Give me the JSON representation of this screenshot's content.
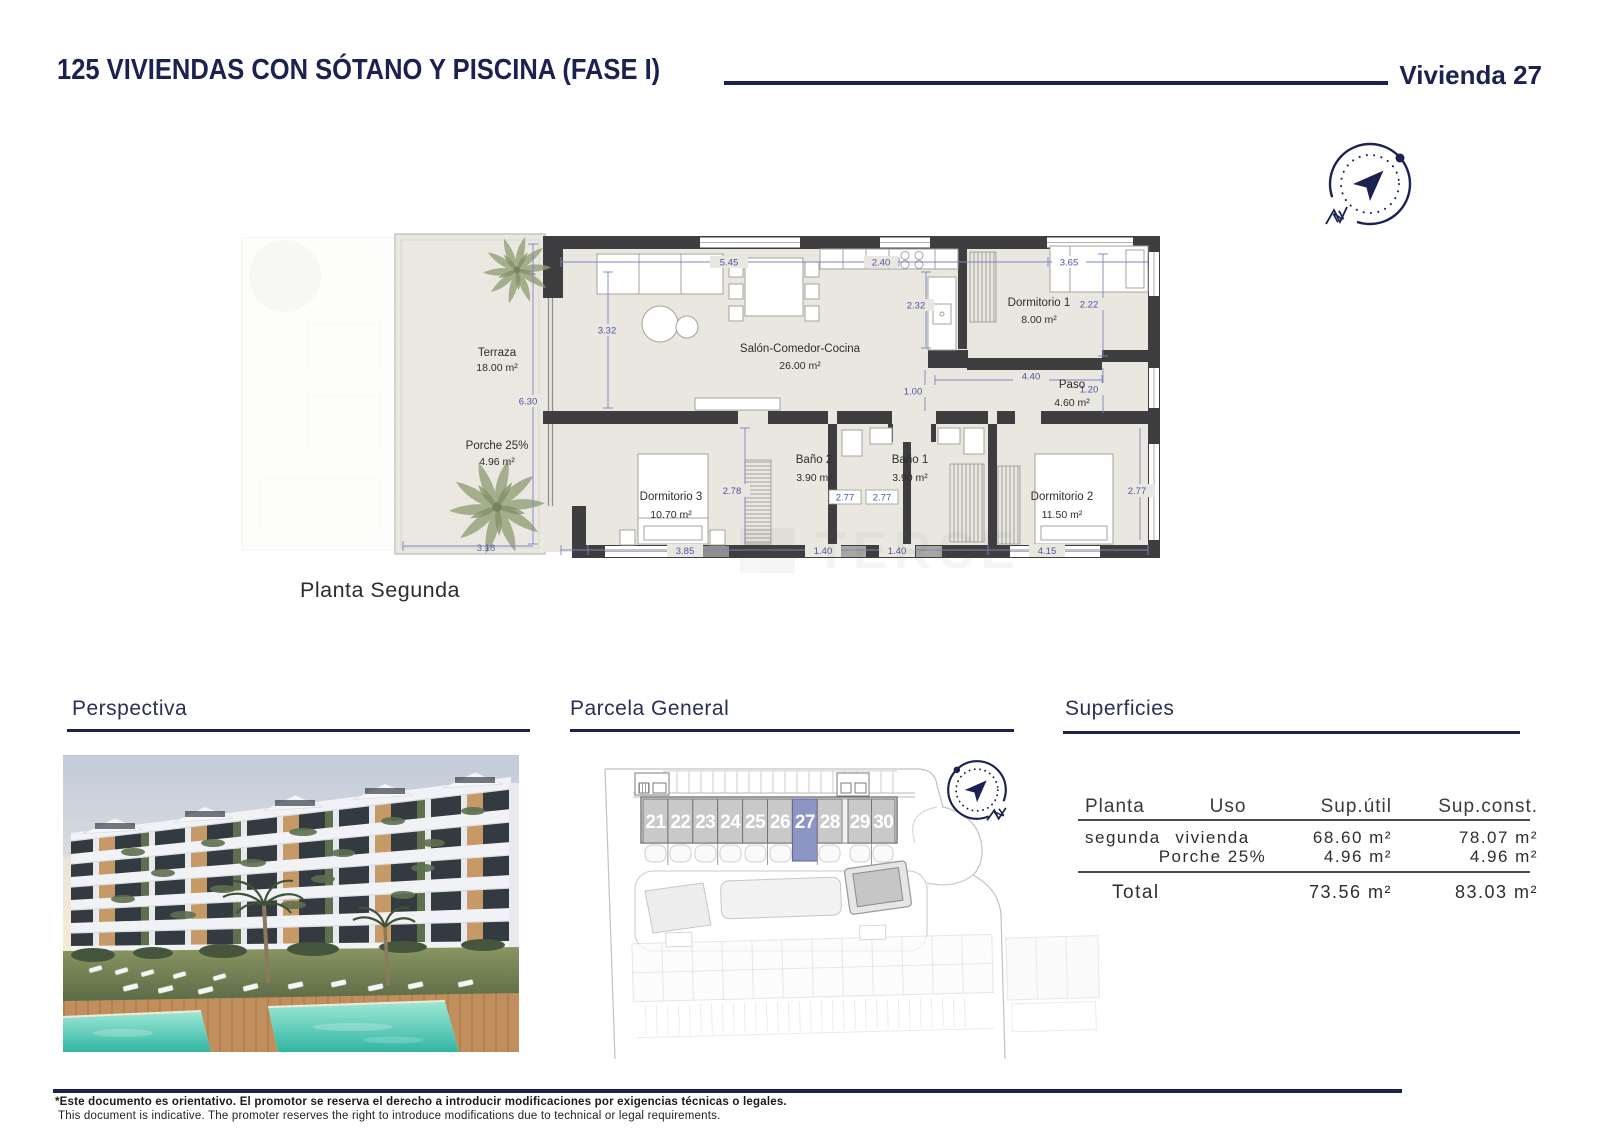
{
  "header": {
    "title": "125 VIVIENDAS CON SÓTANO Y PISCINA (FASE I)",
    "unit_label": "Vivienda 27"
  },
  "compass": {
    "north": "N"
  },
  "floorplan": {
    "caption": "Planta Segunda",
    "watermark": "TERCE",
    "rooms": {
      "terraza": {
        "name": "Terraza",
        "area": "18.00 m²"
      },
      "porche": {
        "name": "Porche 25%",
        "area": "4.96 m²"
      },
      "salon": {
        "name": "Salón-Comedor-Cocina",
        "area": "26.00 m²"
      },
      "dormitorio1": {
        "name": "Dormitorio 1",
        "area": "8.00 m²"
      },
      "paso": {
        "name": "Paso",
        "area": "4.60 m²"
      },
      "dormitorio3": {
        "name": "Dormitorio 3",
        "area": "10.70 m²"
      },
      "bano2": {
        "name": "Baño 2",
        "area": "3.90 m²"
      },
      "bano1": {
        "name": "Baño 1",
        "area": "3.90 m²"
      },
      "dormitorio2": {
        "name": "Dormitorio 2",
        "area": "11.50 m²"
      }
    },
    "dims": {
      "top_a": "5.45",
      "top_b": "2.40",
      "top_c": "3.65",
      "v_living": "3.32",
      "v_kitchen": "2.32",
      "v_dorm1": "2.22",
      "v_terraza": "6.30",
      "h_paso": "4.40",
      "v_corridor": "1.00",
      "w_paso_door": "1.20",
      "v_dorm3": "2.78",
      "w_bano2": "2.77",
      "w_bano1": "2.77",
      "v_dorm2": "2.77",
      "bot_terraza": "3.18",
      "bot_dorm3": "3.85",
      "bot_bano2": "1.40",
      "bot_bano1": "1.40",
      "bot_dorm2": "4.15"
    }
  },
  "sections": {
    "perspectiva": {
      "title": "Perspectiva"
    },
    "parcela": {
      "title": "Parcela General",
      "units": [
        "21",
        "22",
        "23",
        "24",
        "25",
        "26",
        "27",
        "28",
        "29",
        "30"
      ],
      "highlighted_unit": "27"
    },
    "superficies": {
      "title": "Superficies",
      "col_planta": "Planta",
      "col_uso": "Uso",
      "col_util": "Sup.útil",
      "col_const": "Sup.const.",
      "row1": {
        "planta": "segunda",
        "uso": "vivienda",
        "util": "68.60 m²",
        "const": "78.07 m²"
      },
      "row2": {
        "uso": "Porche 25%",
        "util": "4.96 m²",
        "const": "4.96 m²"
      },
      "total": {
        "label": "Total",
        "util": "73.56 m²",
        "const": "83.03 m²"
      }
    }
  },
  "footer": {
    "line1": "*Este documento es orientativo. El promotor se reserva el derecho a introducir modificaciones por exigencias técnicas o legales.",
    "line2": "This document is indicative. The promoter reserves the right to introduce modifications due to technical or legal requirements."
  },
  "colors": {
    "navy": "#1b2150",
    "dim_blue": "#4a54a8",
    "highlight": "#8d95c5",
    "wall": "#3e3e40",
    "floor": "#e9e7e0",
    "pool": "#3cc0ab"
  }
}
